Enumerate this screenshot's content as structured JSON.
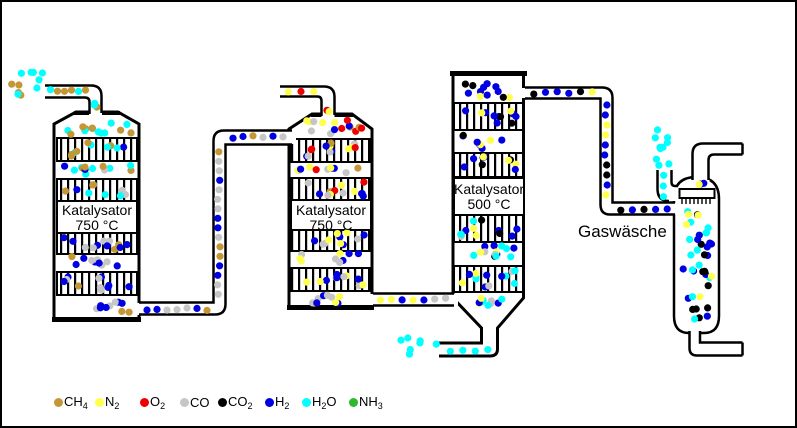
{
  "labels": {
    "washer": "Gaswäsche",
    "reactors": [
      {
        "line1": "Katalysator",
        "line2": "750 °C"
      },
      {
        "line1": "Katalysator",
        "line2": "750 °C"
      },
      {
        "line1": "Katalysator",
        "line2": "500 °C"
      }
    ]
  },
  "species": {
    "ch4": {
      "color": "#C49636",
      "formula": [
        {
          "t": "CH"
        },
        {
          "t": "4",
          "sub": true
        }
      ]
    },
    "n2": {
      "color": "#FFFF4D",
      "formula": [
        {
          "t": "N"
        },
        {
          "t": "2",
          "sub": true
        }
      ]
    },
    "o2": {
      "color": "#EE0000",
      "formula": [
        {
          "t": "O"
        },
        {
          "t": "2",
          "sub": true
        }
      ]
    },
    "co": {
      "color": "#C6C6C6",
      "formula": [
        {
          "t": "CO"
        }
      ]
    },
    "co2": {
      "color": "#000000",
      "formula": [
        {
          "t": "CO"
        },
        {
          "t": "2",
          "sub": true
        }
      ]
    },
    "h2": {
      "color": "#0000E0",
      "formula": [
        {
          "t": "H"
        },
        {
          "t": "2",
          "sub": true
        }
      ]
    },
    "h2o": {
      "color": "#00FFFF",
      "formula": [
        {
          "t": "H"
        },
        {
          "t": "2",
          "sub": true
        },
        {
          "t": "O"
        }
      ]
    },
    "nh3": {
      "color": "#2EB82E",
      "formula": [
        {
          "t": "NH"
        },
        {
          "t": "3",
          "sub": true
        }
      ]
    }
  },
  "legend": {
    "top": 393,
    "items": [
      {
        "s": "ch4",
        "x": 52
      },
      {
        "s": "n2",
        "x": 93
      },
      {
        "s": "o2",
        "x": 138
      },
      {
        "s": "co",
        "x": 178
      },
      {
        "s": "co2",
        "x": 216
      },
      {
        "s": "h2",
        "x": 263
      },
      {
        "s": "h2o",
        "x": 300
      },
      {
        "s": "nh3",
        "x": 347
      }
    ]
  },
  "zones": [
    {
      "n": "feed-free",
      "m": "s",
      "x": 6,
      "y": 66,
      "w": 44,
      "h": 34,
      "d": {
        "h2o": 7,
        "ch4": 4
      }
    },
    {
      "n": "feed-pipe",
      "m": "fh",
      "x": 45,
      "y": 84,
      "w": 42,
      "h": 10,
      "d": {
        "ch4": 4,
        "h2o": 2
      }
    },
    {
      "n": "feed-elbow",
      "m": "s",
      "x": 88,
      "y": 97,
      "w": 11,
      "h": 16,
      "d": {
        "h2o": 2,
        "ch4": 1
      }
    },
    {
      "n": "r1-top",
      "m": "s",
      "x": 57,
      "y": 115,
      "w": 76,
      "h": 21,
      "d": {
        "h2o": 8,
        "ch4": 6
      }
    },
    {
      "n": "r1-bed1",
      "m": "s",
      "x": 57,
      "y": 137,
      "w": 76,
      "h": 21,
      "d": {
        "ch4": 5,
        "h2o": 4,
        "h2": 1
      }
    },
    {
      "n": "r1-gap1",
      "m": "s",
      "x": 57,
      "y": 158,
      "w": 76,
      "h": 19,
      "d": {
        "h2o": 6,
        "ch4": 4,
        "h2": 2,
        "co": 1
      }
    },
    {
      "n": "r1-bed2",
      "m": "s",
      "x": 57,
      "y": 177,
      "w": 76,
      "h": 22,
      "d": {
        "h2o": 3,
        "ch4": 3,
        "co": 2,
        "h2": 1
      }
    },
    {
      "n": "r1-bed3",
      "m": "s",
      "x": 57,
      "y": 231,
      "w": 76,
      "h": 20,
      "d": {
        "h2": 6,
        "co": 4,
        "ch4": 2
      }
    },
    {
      "n": "r1-gap2",
      "m": "s",
      "x": 57,
      "y": 251,
      "w": 76,
      "h": 19,
      "d": {
        "h2": 5,
        "co": 4,
        "ch4": 2
      }
    },
    {
      "n": "r1-bed4",
      "m": "s",
      "x": 57,
      "y": 270,
      "w": 76,
      "h": 22,
      "d": {
        "h2": 6,
        "co": 4,
        "ch4": 1
      }
    },
    {
      "n": "r1-bottom",
      "m": "s",
      "x": 57,
      "y": 292,
      "w": 76,
      "h": 22,
      "d": {
        "h2": 5,
        "co": 3,
        "ch4": 2
      }
    },
    {
      "n": "pipe12-h1",
      "m": "fh",
      "x": 140,
      "y": 302,
      "w": 70,
      "h": 10,
      "d": {
        "h2": 3,
        "co": 3,
        "ch4": 1
      }
    },
    {
      "n": "pipe12-v",
      "m": "fv",
      "x": 212,
      "y": 145,
      "w": 10,
      "h": 152,
      "d": {
        "co": 8,
        "h2": 5,
        "ch4": 3
      }
    },
    {
      "n": "pipe12-h2",
      "m": "fh",
      "x": 226,
      "y": 130,
      "w": 60,
      "h": 10,
      "d": {
        "h2": 3,
        "co": 2,
        "ch4": 1
      }
    },
    {
      "n": "air-pipe",
      "m": "fh",
      "x": 280,
      "y": 85,
      "w": 38,
      "h": 9,
      "d": {
        "n2": 2,
        "o2": 1
      }
    },
    {
      "n": "air-elbow",
      "m": "s",
      "x": 321,
      "y": 97,
      "w": 11,
      "h": 17,
      "d": {
        "o2": 1,
        "n2": 1
      }
    },
    {
      "n": "r2-top",
      "m": "s",
      "x": 292,
      "y": 114,
      "w": 74,
      "h": 22,
      "d": {
        "o2": 4,
        "n2": 4,
        "co": 3,
        "h2": 2,
        "ch4": 2
      }
    },
    {
      "n": "r2-bed1",
      "m": "s",
      "x": 292,
      "y": 137,
      "w": 74,
      "h": 21,
      "d": {
        "o2": 3,
        "h2": 3,
        "n2": 3,
        "co": 3,
        "ch4": 1
      }
    },
    {
      "n": "r2-gap1",
      "m": "s",
      "x": 292,
      "y": 158,
      "w": 74,
      "h": 17,
      "d": {
        "h2": 3,
        "n2": 3,
        "co": 3,
        "o2": 1,
        "ch4": 1
      }
    },
    {
      "n": "r2-bed2",
      "m": "s",
      "x": 292,
      "y": 176,
      "w": 74,
      "h": 22,
      "d": {
        "h2": 4,
        "n2": 3,
        "co": 3,
        "o2": 2,
        "ch4": 1
      }
    },
    {
      "n": "r2-bed3",
      "m": "s",
      "x": 292,
      "y": 227,
      "w": 74,
      "h": 21,
      "d": {
        "n2": 4,
        "h2": 4,
        "co": 3
      }
    },
    {
      "n": "r2-gap2",
      "m": "s",
      "x": 292,
      "y": 248,
      "w": 74,
      "h": 17,
      "d": {
        "h2": 3,
        "n2": 3,
        "co": 3
      }
    },
    {
      "n": "r2-bed4",
      "m": "s",
      "x": 292,
      "y": 266,
      "w": 74,
      "h": 22,
      "d": {
        "n2": 4,
        "h2": 4,
        "co": 3
      }
    },
    {
      "n": "r2-bottom",
      "m": "s",
      "x": 292,
      "y": 288,
      "w": 74,
      "h": 17,
      "d": {
        "co": 4,
        "h2": 3,
        "n2": 3
      }
    },
    {
      "n": "pipe23",
      "m": "fh",
      "x": 373,
      "y": 292,
      "w": 76,
      "h": 11,
      "d": {
        "n2": 3,
        "co": 2,
        "h2": 2
      }
    },
    {
      "n": "r3-top",
      "m": "s",
      "x": 455,
      "y": 75,
      "w": 64,
      "h": 25,
      "d": {
        "h2": 7,
        "co2": 3,
        "n2": 2
      }
    },
    {
      "n": "r3-bed1",
      "m": "s",
      "x": 455,
      "y": 101,
      "w": 64,
      "h": 26,
      "d": {
        "h2": 7,
        "co2": 2,
        "n2": 2
      }
    },
    {
      "n": "r3-gap1",
      "m": "s",
      "x": 455,
      "y": 128,
      "w": 64,
      "h": 22,
      "d": {
        "h2": 5,
        "n2": 2,
        "co2": 1
      }
    },
    {
      "n": "r3-bed2",
      "m": "s",
      "x": 455,
      "y": 151,
      "w": 64,
      "h": 24,
      "d": {
        "h2": 5,
        "n2": 3,
        "co2": 2
      }
    },
    {
      "n": "r3-bed3",
      "m": "s",
      "x": 455,
      "y": 213,
      "w": 64,
      "h": 26,
      "d": {
        "h2": 4,
        "h2o": 3,
        "n2": 2,
        "co2": 2,
        "co": 1
      }
    },
    {
      "n": "r3-gap2",
      "m": "s",
      "x": 455,
      "y": 239,
      "w": 64,
      "h": 25,
      "d": {
        "h2o": 5,
        "h2": 4,
        "n2": 2,
        "co": 2,
        "co2": 1
      }
    },
    {
      "n": "r3-bed4",
      "m": "s",
      "x": 455,
      "y": 264,
      "w": 64,
      "h": 26,
      "d": {
        "h2o": 5,
        "h2": 4,
        "n2": 2,
        "co": 2
      }
    },
    {
      "n": "r3-funnel",
      "m": "s",
      "x": 464,
      "y": 291,
      "w": 40,
      "h": 16,
      "d": {
        "h2o": 4,
        "h2": 2,
        "co": 2,
        "n2": 2
      }
    },
    {
      "n": "pipe3w-h1",
      "m": "fh",
      "x": 526,
      "y": 86,
      "w": 70,
      "h": 10,
      "d": {
        "h2": 3,
        "co2": 2,
        "n2": 1
      }
    },
    {
      "n": "pipe3w-v",
      "m": "fv",
      "x": 599,
      "y": 98,
      "w": 10,
      "h": 100,
      "d": {
        "h2": 5,
        "n2": 3,
        "co2": 2
      }
    },
    {
      "n": "pipe3w-h2",
      "m": "fh",
      "x": 613,
      "y": 202,
      "w": 58,
      "h": 10,
      "d": {
        "h2": 3,
        "co2": 2
      }
    },
    {
      "n": "water-free",
      "m": "s",
      "x": 649,
      "y": 121,
      "w": 22,
      "h": 46,
      "d": {
        "h2o": 10
      }
    },
    {
      "n": "water-pipe",
      "m": "fv",
      "x": 657,
      "y": 168,
      "w": 11,
      "h": 32,
      "d": {
        "h2o": 3
      }
    },
    {
      "n": "washer-dome",
      "m": "s",
      "x": 678,
      "y": 177,
      "w": 34,
      "h": 11,
      "d": {
        "h2": 2,
        "n2": 1
      }
    },
    {
      "n": "washer-upper",
      "m": "s",
      "x": 677,
      "y": 206,
      "w": 37,
      "h": 52,
      "d": {
        "h2o": 8,
        "h2": 6,
        "co2": 3,
        "n2": 3
      }
    },
    {
      "n": "washer-lower",
      "m": "s",
      "x": 677,
      "y": 258,
      "w": 37,
      "h": 44,
      "d": {
        "h2o": 4,
        "h2": 4,
        "co2": 4,
        "n2": 2
      }
    },
    {
      "n": "washer-bottom",
      "m": "s",
      "x": 682,
      "y": 300,
      "w": 28,
      "h": 22,
      "d": {
        "co2": 4,
        "h2": 1,
        "h2o": 1
      }
    },
    {
      "n": "drain3-pipe",
      "m": "fh",
      "x": 442,
      "y": 344,
      "w": 50,
      "h": 9,
      "d": {
        "h2o": 4
      }
    },
    {
      "n": "drain3-free",
      "m": "s",
      "x": 394,
      "y": 331,
      "w": 48,
      "h": 26,
      "d": {
        "h2o": 7
      }
    }
  ]
}
